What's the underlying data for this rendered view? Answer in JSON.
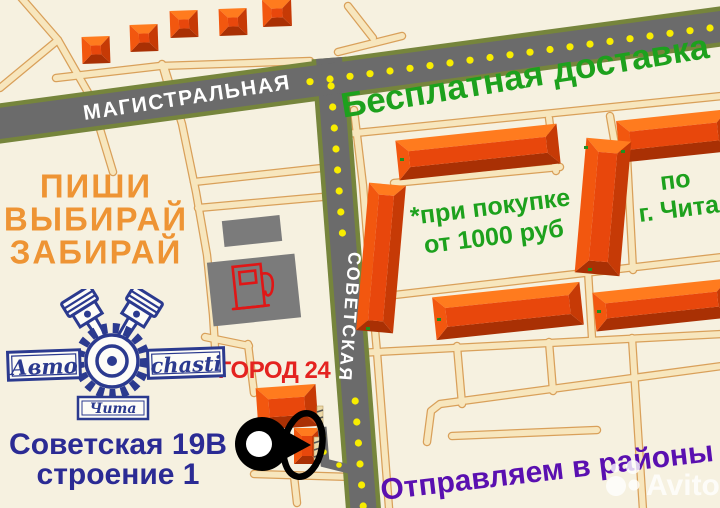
{
  "streets": {
    "magistralnaya": "МАГИСТРАЛЬНАЯ",
    "sovetskaya": "СОВЕТСКАЯ"
  },
  "promo": {
    "free_delivery": "Бесплатная доставка",
    "cta_line1": "ПИШИ",
    "cta_line2": "ВЫБИРАЙ",
    "cta_line3": "ЗАБИРАЙ",
    "condition_line1": "*при покупке",
    "condition_line2": "от 1000 руб",
    "city_line1": "по",
    "city_line2": "г. Чита",
    "districts": "Отправляем в районы"
  },
  "landmark": {
    "store": "ГОРОД 24"
  },
  "address": {
    "line1": "Советская 19В",
    "line2": "строение 1"
  },
  "logo": {
    "left": "Авто",
    "right": "chasti",
    "bottom": "Чита"
  },
  "watermark": "Avito",
  "colors": {
    "background": "#f6f1e0",
    "green": "#1da11d",
    "orange": "#ee9434",
    "red": "#e42320",
    "navy": "#2b2b94",
    "purple": "#5a10b0",
    "building": "#e8470c",
    "road_gray": "#6b6b6b",
    "road_border_olive": "#76853c",
    "dot_yellow": "#f8ed00",
    "minor_road": "#f7e6bd",
    "minor_road_edge": "#d9a05a",
    "logo_navy": "#2b3a8f",
    "station_gray": "#7b7b7b"
  }
}
